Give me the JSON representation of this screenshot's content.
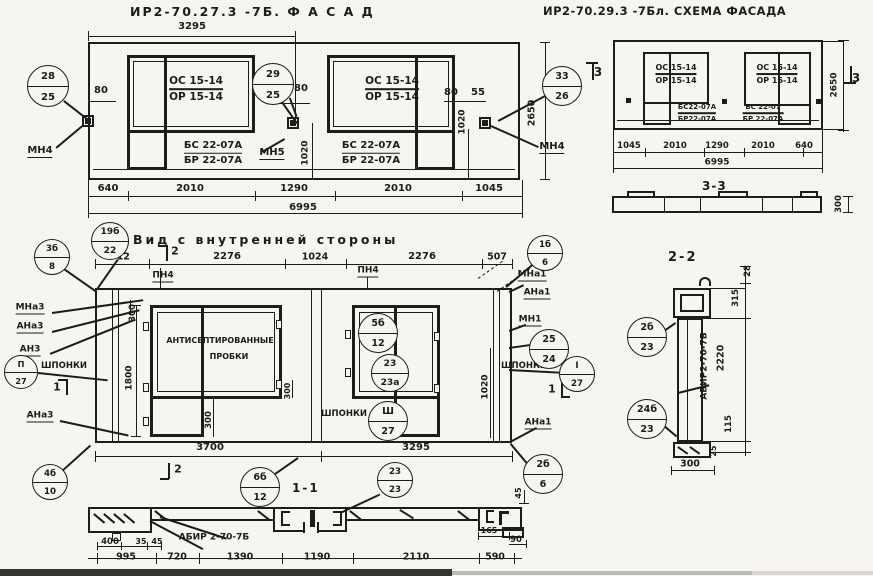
{
  "titles": {
    "facade": "ИР2-70.27.3 -7Б.   Ф А С А Д",
    "schema": "ИР2-70.29.3 -7Бл. СХЕМА ФАСАДА",
    "inner_view": "Вид с внутренней стороны",
    "section_1_1": "1-1",
    "section_2_2": "2-2",
    "section_3_3": "3-3"
  },
  "labels": [
    {
      "t": "3295",
      "x": 192,
      "y": 27
    },
    {
      "t": "80",
      "x": 101,
      "y": 91
    },
    {
      "t": "5",
      "x": 281,
      "y": 95,
      "s": 9
    },
    {
      "t": "80",
      "x": 301,
      "y": 89
    },
    {
      "t": "80",
      "x": 451,
      "y": 93
    },
    {
      "t": "55",
      "x": 478,
      "y": 93
    },
    {
      "t": "1020",
      "x": 306,
      "y": 153,
      "r": 1,
      "s": 9
    },
    {
      "t": "1020",
      "x": 463,
      "y": 122,
      "r": 1,
      "s": 9
    },
    {
      "t": "2650",
      "x": 532,
      "y": 113,
      "r": 1,
      "s": 9.5
    },
    {
      "t": "МН4",
      "x": 40,
      "y": 152,
      "u": 1,
      "n": "anchor-label-mn4-left"
    },
    {
      "t": "МН5",
      "x": 272,
      "y": 154,
      "u": 1,
      "n": "anchor-label-mn5"
    },
    {
      "t": "МН4",
      "x": 552,
      "y": 148,
      "u": 1,
      "n": "anchor-label-mn4-right"
    },
    {
      "t": "640",
      "x": 108,
      "y": 189
    },
    {
      "t": "2010",
      "x": 190,
      "y": 189
    },
    {
      "t": "1290",
      "x": 294,
      "y": 189
    },
    {
      "t": "2010",
      "x": 398,
      "y": 189
    },
    {
      "t": "1045",
      "x": 489,
      "y": 189
    },
    {
      "t": "6995",
      "x": 303,
      "y": 208
    },
    {
      "t": "3",
      "x": 598,
      "y": 72,
      "s": 12,
      "n": "section-marker-3"
    },
    {
      "t": "3",
      "x": 856,
      "y": 78,
      "s": 12,
      "n": "section-marker-3"
    },
    {
      "t": "1045",
      "x": 629,
      "y": 146,
      "s": 8.5
    },
    {
      "t": "2010",
      "x": 675,
      "y": 146,
      "s": 8.5
    },
    {
      "t": "1290",
      "x": 717,
      "y": 146,
      "s": 8.5
    },
    {
      "t": "2010",
      "x": 763,
      "y": 146,
      "s": 8.5
    },
    {
      "t": "640",
      "x": 804,
      "y": 146,
      "s": 8.5
    },
    {
      "t": "6995",
      "x": 717,
      "y": 163,
      "s": 9
    },
    {
      "t": "2650",
      "x": 835,
      "y": 85,
      "r": 1,
      "s": 9
    },
    {
      "t": "300",
      "x": 839,
      "y": 204,
      "r": 1,
      "s": 8.5
    },
    {
      "t": "912",
      "x": 120,
      "y": 257,
      "s": 9.5
    },
    {
      "t": "2276",
      "x": 227,
      "y": 257
    },
    {
      "t": "1024",
      "x": 315,
      "y": 257,
      "s": 9.5
    },
    {
      "t": "2276",
      "x": 422,
      "y": 257
    },
    {
      "t": "507",
      "x": 497,
      "y": 257,
      "s": 9.5
    },
    {
      "t": "2",
      "x": 175,
      "y": 251,
      "s": 11,
      "n": "section-marker-2"
    },
    {
      "t": "ПН4",
      "x": 163,
      "y": 277,
      "u": 1,
      "s": 9,
      "n": "joint-label-pn4"
    },
    {
      "t": "ПН4",
      "x": 368,
      "y": 272,
      "u": 1,
      "s": 9,
      "n": "joint-label-pn4"
    },
    {
      "t": "МНа3",
      "x": 30,
      "y": 309,
      "u": 1,
      "s": 9
    },
    {
      "t": "АНа3",
      "x": 30,
      "y": 328,
      "u": 1,
      "s": 9
    },
    {
      "t": "АН3",
      "x": 30,
      "y": 351,
      "u": 1,
      "s": 9
    },
    {
      "t": "ШПОНКИ",
      "x": 64,
      "y": 366,
      "s": 8.5,
      "n": "keys-label"
    },
    {
      "t": "АНа3",
      "x": 40,
      "y": 417,
      "u": 1,
      "s": 9
    },
    {
      "t": "1",
      "x": 57,
      "y": 387,
      "s": 11,
      "n": "section-marker-1"
    },
    {
      "t": "АНТИСЕПТИРОВАННЫЕ",
      "x": 220,
      "y": 341,
      "s": 8,
      "n": "note-antiseptic-line1"
    },
    {
      "t": "ПРОБКИ",
      "x": 229,
      "y": 357,
      "s": 8,
      "n": "note-antiseptic-line2"
    },
    {
      "t": "300",
      "x": 133,
      "y": 313,
      "r": 1,
      "s": 8.5
    },
    {
      "t": "1800",
      "x": 130,
      "y": 378,
      "r": 1,
      "s": 9
    },
    {
      "t": "300",
      "x": 209,
      "y": 420,
      "r": 1,
      "s": 8.5
    },
    {
      "t": "300",
      "x": 288,
      "y": 391,
      "r": 1,
      "s": 8
    },
    {
      "t": "ШПОНКИ",
      "x": 344,
      "y": 414,
      "s": 8.5,
      "n": "keys-label"
    },
    {
      "t": "1020",
      "x": 486,
      "y": 387,
      "r": 1,
      "s": 9
    },
    {
      "t": "МНа1",
      "x": 532,
      "y": 276,
      "u": 1,
      "s": 9
    },
    {
      "t": "АНа1",
      "x": 537,
      "y": 294,
      "u": 1,
      "s": 9
    },
    {
      "t": "МН1",
      "x": 530,
      "y": 321,
      "u": 1,
      "s": 9
    },
    {
      "t": "ШПОНКИ",
      "x": 524,
      "y": 366,
      "s": 8.5,
      "n": "keys-label"
    },
    {
      "t": "1",
      "x": 552,
      "y": 389,
      "s": 11,
      "n": "section-marker-1"
    },
    {
      "t": "АНа1",
      "x": 538,
      "y": 424,
      "u": 1,
      "s": 9
    },
    {
      "t": "3700",
      "x": 210,
      "y": 448
    },
    {
      "t": "3295",
      "x": 416,
      "y": 448
    },
    {
      "t": "2",
      "x": 178,
      "y": 469,
      "s": 11,
      "n": "section-marker-2"
    },
    {
      "t": "АБИР 2-70-7Б",
      "x": 214,
      "y": 538,
      "s": 9,
      "n": "panel-mark-label"
    },
    {
      "t": "400",
      "x": 110,
      "y": 542,
      "s": 8.5
    },
    {
      "t": "35",
      "x": 141,
      "y": 542,
      "s": 8
    },
    {
      "t": "45",
      "x": 157,
      "y": 542,
      "s": 8
    },
    {
      "t": "995",
      "x": 126,
      "y": 557,
      "s": 9.5
    },
    {
      "t": "720",
      "x": 177,
      "y": 557,
      "s": 9.5
    },
    {
      "t": "1390",
      "x": 240,
      "y": 557,
      "s": 9.5
    },
    {
      "t": "1190",
      "x": 317,
      "y": 557,
      "s": 9.5
    },
    {
      "t": "2110",
      "x": 416,
      "y": 557,
      "s": 9.5
    },
    {
      "t": "590",
      "x": 495,
      "y": 557,
      "s": 9.5
    },
    {
      "t": "165",
      "x": 489,
      "y": 531,
      "s": 8
    },
    {
      "t": "90",
      "x": 516,
      "y": 540,
      "s": 8.5
    },
    {
      "t": "45",
      "x": 519,
      "y": 493,
      "r": 1,
      "s": 8
    },
    {
      "t": "АБИР2-70-7Б",
      "x": 705,
      "y": 366,
      "r": 1,
      "s": 9,
      "n": "panel-mark-label"
    },
    {
      "t": "2220",
      "x": 721,
      "y": 358,
      "r": 1,
      "s": 9.5
    },
    {
      "t": "28",
      "x": 748,
      "y": 271,
      "r": 1,
      "s": 8.5
    },
    {
      "t": "315",
      "x": 736,
      "y": 298,
      "r": 1,
      "s": 8.5
    },
    {
      "t": "115",
      "x": 729,
      "y": 424,
      "r": 1,
      "s": 8.5
    },
    {
      "t": "25",
      "x": 714,
      "y": 451,
      "r": 1,
      "s": 8
    },
    {
      "t": "300",
      "x": 690,
      "y": 464,
      "s": 9.5
    }
  ],
  "fractions": [
    {
      "a": "ОС 15-14",
      "b": "ОР 15-14",
      "x": 196,
      "y": 89,
      "s": 10.5,
      "n": "window-mark"
    },
    {
      "a": "ОС 15-14",
      "b": "ОР 15-14",
      "x": 392,
      "y": 89,
      "s": 10.5,
      "n": "window-mark"
    },
    {
      "a": "БС 22-07А",
      "b": "БР 22-07А",
      "x": 213,
      "y": 153,
      "s": 10,
      "n": "block-mark"
    },
    {
      "a": "БС 22-07А",
      "b": "БР 22-07А",
      "x": 371,
      "y": 153,
      "s": 10,
      "n": "block-mark"
    },
    {
      "a": "ОС 15-14",
      "b": "ОР 15-14",
      "x": 676,
      "y": 74,
      "s": 8,
      "n": "window-mark"
    },
    {
      "a": "ОС 15-14",
      "b": "ОР 15-14",
      "x": 777,
      "y": 74,
      "s": 8,
      "n": "window-mark"
    },
    {
      "a": "БС22-07А",
      "b": "БР22-07А",
      "x": 697,
      "y": 113,
      "s": 7,
      "n": "block-mark"
    },
    {
      "a": "БС 22-07",
      "b": "БР 22-07А",
      "x": 763,
      "y": 113,
      "s": 7,
      "n": "block-mark"
    }
  ],
  "circles": [
    {
      "a": "28",
      "b": "25",
      "x": 48,
      "y": 86,
      "r": 21
    },
    {
      "a": "29",
      "b": "25",
      "x": 273,
      "y": 84,
      "r": 21
    },
    {
      "a": "33",
      "b": "26",
      "x": 562,
      "y": 86,
      "r": 20
    },
    {
      "a": "19б",
      "b": "22",
      "x": 110,
      "y": 241,
      "r": 19
    },
    {
      "a": "3б",
      "b": "8",
      "x": 52,
      "y": 257,
      "r": 18
    },
    {
      "a": "1б",
      "b": "6",
      "x": 545,
      "y": 253,
      "r": 18
    },
    {
      "a": "П",
      "b": "27",
      "x": 21,
      "y": 372,
      "r": 17
    },
    {
      "a": "5б",
      "b": "12",
      "x": 378,
      "y": 333,
      "r": 20
    },
    {
      "a": "23",
      "b": "23а",
      "x": 390,
      "y": 373,
      "r": 19
    },
    {
      "a": "Ш",
      "b": "27",
      "x": 388,
      "y": 421,
      "r": 20
    },
    {
      "a": "25",
      "b": "24",
      "x": 549,
      "y": 349,
      "r": 20
    },
    {
      "a": "I",
      "b": "27",
      "x": 577,
      "y": 374,
      "r": 18
    },
    {
      "a": "4б",
      "b": "10",
      "x": 50,
      "y": 482,
      "r": 18
    },
    {
      "a": "6б",
      "b": "12",
      "x": 260,
      "y": 487,
      "r": 20
    },
    {
      "a": "23",
      "b": "23",
      "x": 395,
      "y": 480,
      "r": 18
    },
    {
      "a": "2б",
      "b": "6",
      "x": 543,
      "y": 474,
      "r": 20
    },
    {
      "a": "2б",
      "b": "23",
      "x": 647,
      "y": 337,
      "r": 20
    },
    {
      "a": "24б",
      "b": "23",
      "x": 647,
      "y": 419,
      "r": 20
    }
  ]
}
